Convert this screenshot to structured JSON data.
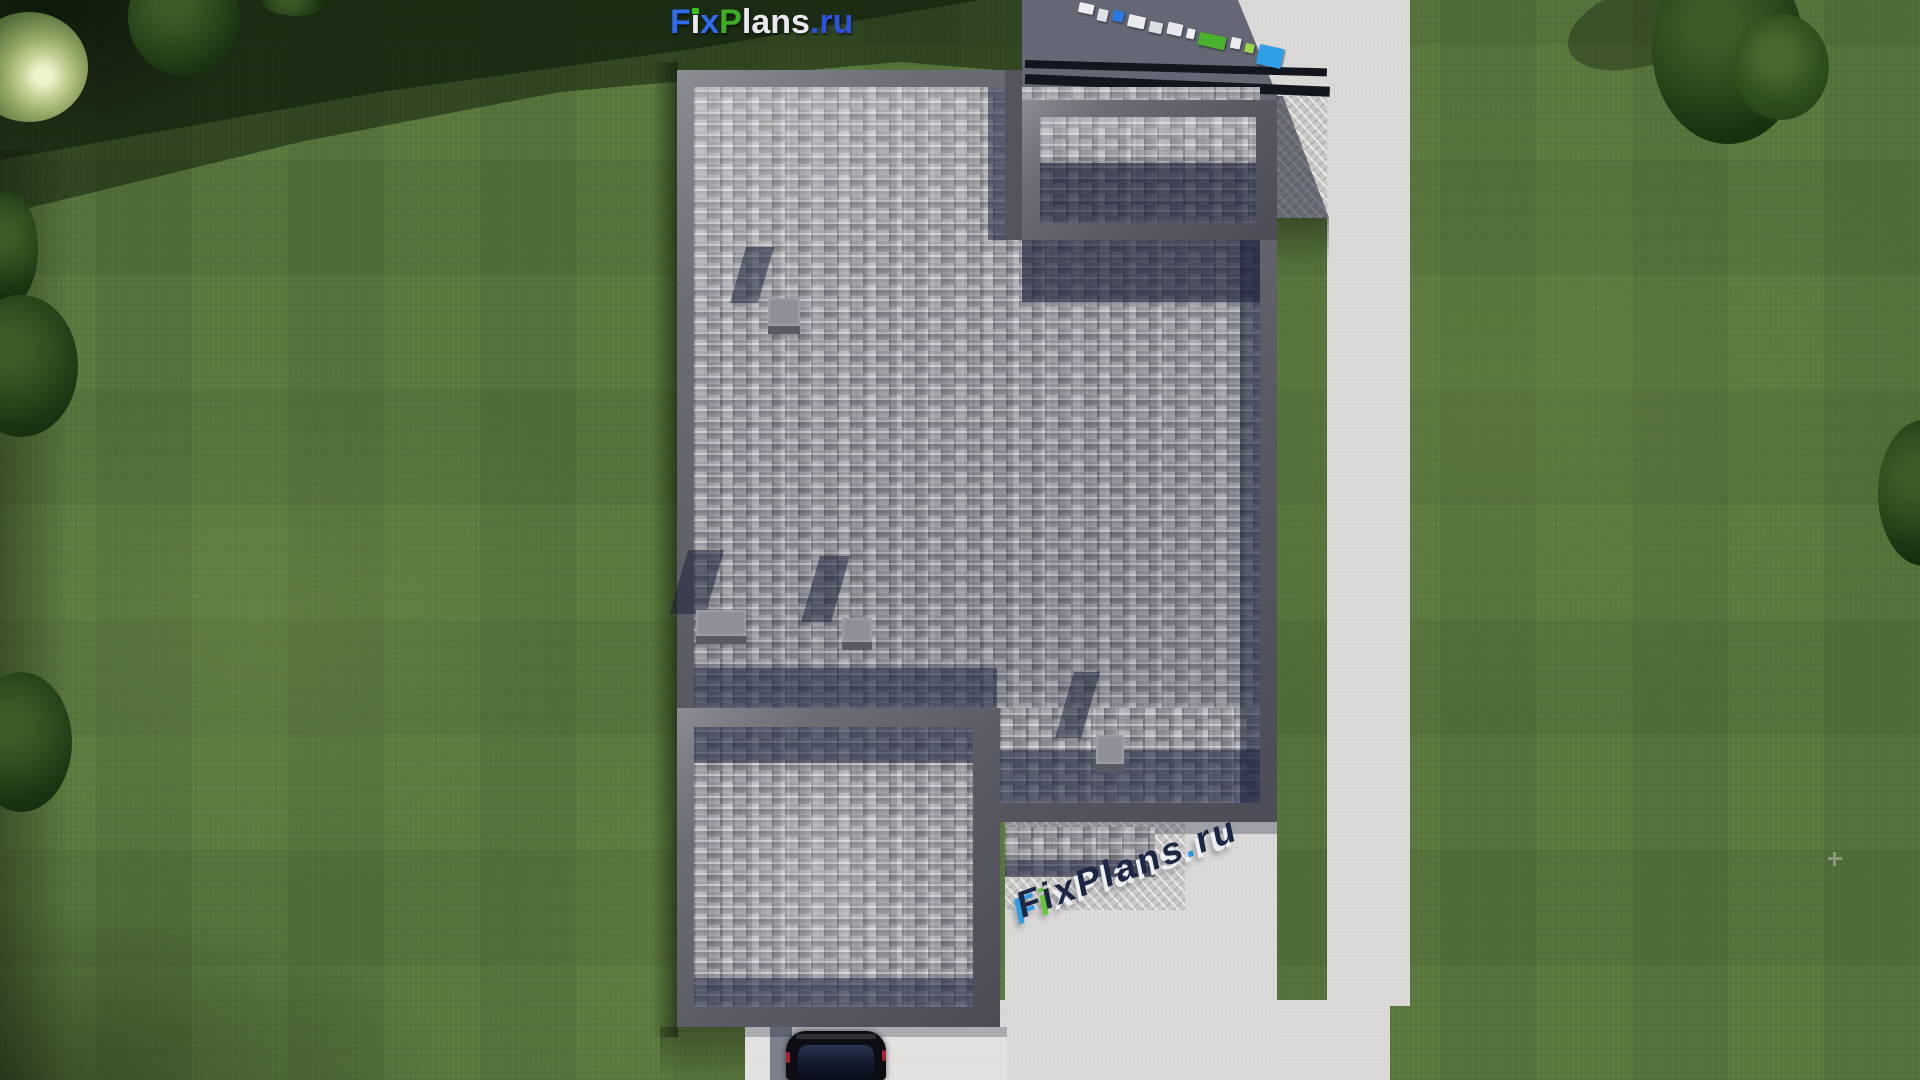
{
  "brand": {
    "name": "FixPlans.ru",
    "accent_blue": "#2e6bee",
    "accent_green": "#3fae27",
    "accent_navy": "#1c2746"
  },
  "logo_top": {
    "segments": [
      {
        "text": "F",
        "color": "#2e6bee"
      },
      {
        "text": "i",
        "color": "#e9e9ef"
      },
      {
        "text": "x",
        "color": "#2e6bee"
      },
      {
        "text": "P",
        "color": "#3fae27"
      },
      {
        "text": "lans",
        "color": "#e9e9ef"
      },
      {
        "text": ".ru",
        "color": "#2d52e0"
      }
    ]
  },
  "watermark_bottom": {
    "text": "FixPlans.ru",
    "segments": [
      {
        "text": "F"
      },
      {
        "text": "i"
      },
      {
        "text": "x"
      },
      {
        "text": "P"
      },
      {
        "text": "l"
      },
      {
        "text": "a"
      },
      {
        "text": "n"
      },
      {
        "text": "s"
      },
      {
        "text": "."
      },
      {
        "text": "r"
      },
      {
        "text": "u"
      }
    ]
  },
  "watermark_top_right": {
    "text": "FixPlans.ru"
  },
  "palette": {
    "lawn_green": "#5d7c40",
    "lawn_shadow": "#16290f",
    "roof_shingle_gray": "#a6a5a9",
    "parapet_gray": "#5a5b64",
    "concrete_light": "#d9d8d6",
    "concrete_rough": "#cccac8",
    "shadow_navy": "#1b233e",
    "car_black": "#0c0e13",
    "tree_green_dark": "#1a3312"
  }
}
